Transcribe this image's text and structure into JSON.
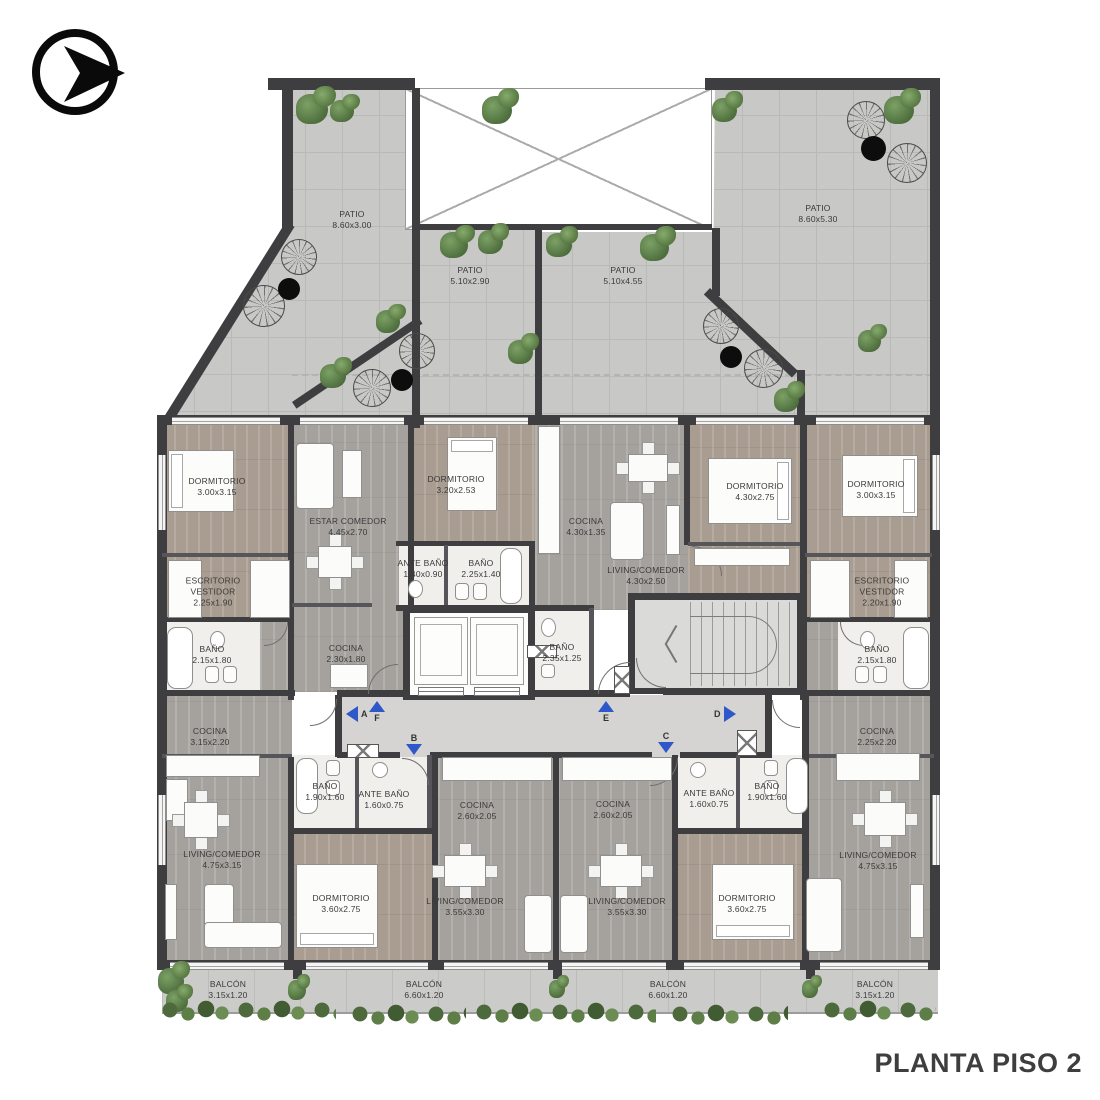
{
  "title": "PLANTA PISO 2",
  "logo": {
    "icon": "circle-arrow-right"
  },
  "colors": {
    "wall": "#3e3e40",
    "patio_floor": "#c8c8c7",
    "wood_floor": "#a5a29e",
    "bedroom_floor": "#a99c90",
    "tile_floor": "#f0efec",
    "corridor_floor": "#d5d4d2",
    "balcony_floor": "#cbcbca",
    "arrow_blue": "#2e57c9",
    "plant_green": "#557342",
    "text": "#3a3a3a"
  },
  "corridor": {
    "markers": {
      "a": "A",
      "b": "B",
      "c": "C",
      "d": "D",
      "e": "E",
      "f": "F"
    }
  },
  "rooms": {
    "patio_l": {
      "name": "PATIO",
      "dims": "8.60x3.00"
    },
    "patio_m1": {
      "name": "PATIO",
      "dims": "5.10x2.90"
    },
    "patio_m2": {
      "name": "PATIO",
      "dims": "5.10x4.55"
    },
    "patio_r": {
      "name": "PATIO",
      "dims": "8.60x5.30"
    },
    "dorm_1l": {
      "name": "DORMITORIO",
      "dims": "3.00x3.15"
    },
    "escr_l": {
      "name": "ESCRITORIO VESTIDOR",
      "dims": "2.25x1.90"
    },
    "bano_1l": {
      "name": "BAÑO",
      "dims": "2.15x1.80"
    },
    "cocina_al": {
      "name": "COCINA",
      "dims": "3.15x2.20"
    },
    "estar": {
      "name": "ESTAR COMEDOR",
      "dims": "4.45x2.70"
    },
    "cocina_2": {
      "name": "COCINA",
      "dims": "2.30x1.80"
    },
    "dorm_2": {
      "name": "DORMITORIO",
      "dims": "3.20x2.53"
    },
    "ante_2": {
      "name": "ANTE BAÑO",
      "dims": "1.40x0.90"
    },
    "bano_2": {
      "name": "BAÑO",
      "dims": "2.25x1.40"
    },
    "cocina_c": {
      "name": "COCINA",
      "dims": "4.30x1.35"
    },
    "living_c": {
      "name": "LIVING/COMEDOR",
      "dims": "4.30x2.50"
    },
    "bano_c": {
      "name": "BAÑO",
      "dims": "2.35x1.25"
    },
    "dorm_c": {
      "name": "DORMITORIO",
      "dims": "4.30x2.75"
    },
    "dorm_1r": {
      "name": "DORMITORIO",
      "dims": "3.00x3.15"
    },
    "escr_r": {
      "name": "ESCRITORIO VESTIDOR",
      "dims": "2.20x1.90"
    },
    "bano_1r": {
      "name": "BAÑO",
      "dims": "2.15x1.80"
    },
    "cocina_ar": {
      "name": "COCINA",
      "dims": "2.25x2.20"
    },
    "bano_bl": {
      "name": "BAÑO",
      "dims": "1.90x1.60"
    },
    "ante_bl": {
      "name": "ANTE BAÑO",
      "dims": "1.60x0.75"
    },
    "living_bl": {
      "name": "LIVING/COMEDOR",
      "dims": "4.75x3.15"
    },
    "dorm_bl": {
      "name": "DORMITORIO",
      "dims": "3.60x2.75"
    },
    "cocina_cl": {
      "name": "COCINA",
      "dims": "2.60x2.05"
    },
    "living_cl": {
      "name": "LIVING/COMEDOR",
      "dims": "3.55x3.30"
    },
    "cocina_cr": {
      "name": "COCINA",
      "dims": "2.60x2.05"
    },
    "living_cr": {
      "name": "LIVING/COMEDOR",
      "dims": "3.55x3.30"
    },
    "ante_br": {
      "name": "ANTE BAÑO",
      "dims": "1.60x0.75"
    },
    "bano_br": {
      "name": "BAÑO",
      "dims": "1.90x1.60"
    },
    "dorm_br": {
      "name": "DORMITORIO",
      "dims": "3.60x2.75"
    },
    "living_r": {
      "name": "LIVING/COMEDOR",
      "dims": "4.75x3.15"
    },
    "balcon_l": {
      "name": "BALCÓN",
      "dims": "3.15x1.20"
    },
    "balcon_cl": {
      "name": "BALCÓN",
      "dims": "6.60x1.20"
    },
    "balcon_cr": {
      "name": "BALCÓN",
      "dims": "6.60x1.20"
    },
    "balcon_r": {
      "name": "BALCÓN",
      "dims": "3.15x1.20"
    }
  }
}
